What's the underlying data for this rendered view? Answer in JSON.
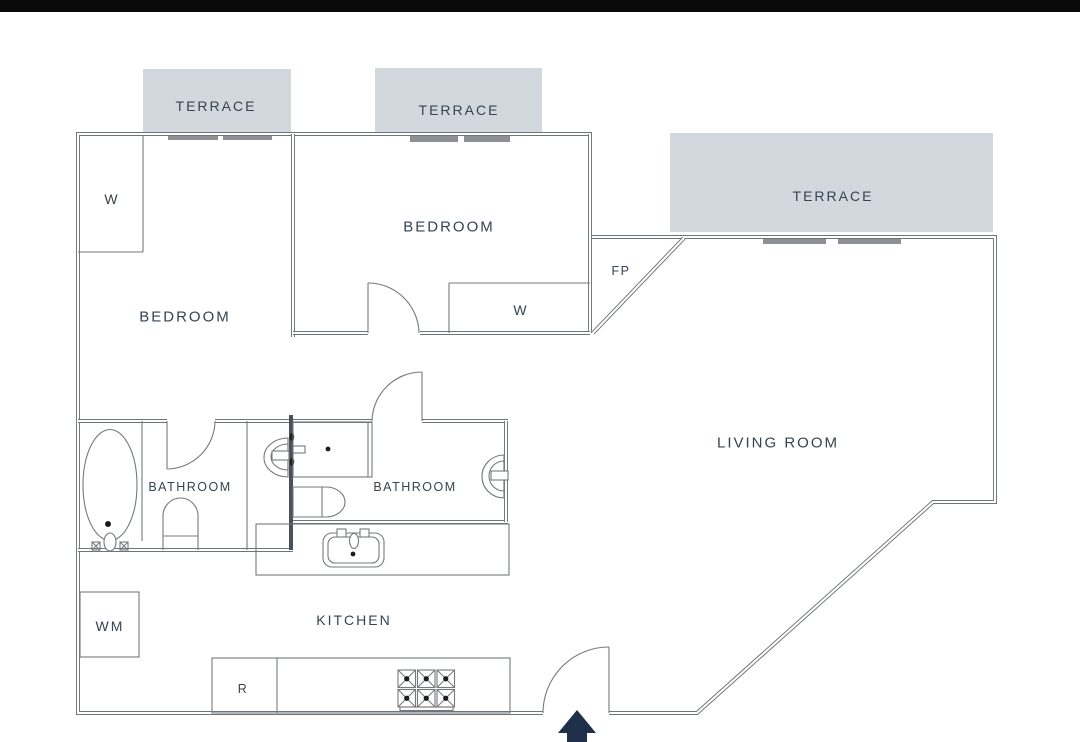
{
  "floor_plan": {
    "terraces": [
      "TERRACE",
      "TERRACE",
      "TERRACE"
    ],
    "bedroom1_label": "BEDROOM",
    "bedroom2_label": "BEDROOM",
    "living_room_label": "LIVING ROOM",
    "bathroom1_label": "BATHROOM",
    "bathroom2_label": "BATHROOM",
    "kitchen_label": "KITCHEN",
    "wardrobe1_label": "W",
    "wardrobe2_label": "W",
    "fireplace_label": "FP",
    "washing_machine_label": "WM",
    "refrigerator_label": "R",
    "colors": {
      "wall_line": "#6f7478",
      "thick_wall": "#4b5156",
      "label_text": "#364350",
      "terrace_fill": "#d3d7de",
      "window_bar": "#8d9195",
      "entrance_arrow": "#20304a",
      "top_bar": "#0a0a0a",
      "background": "#ffffff"
    }
  }
}
